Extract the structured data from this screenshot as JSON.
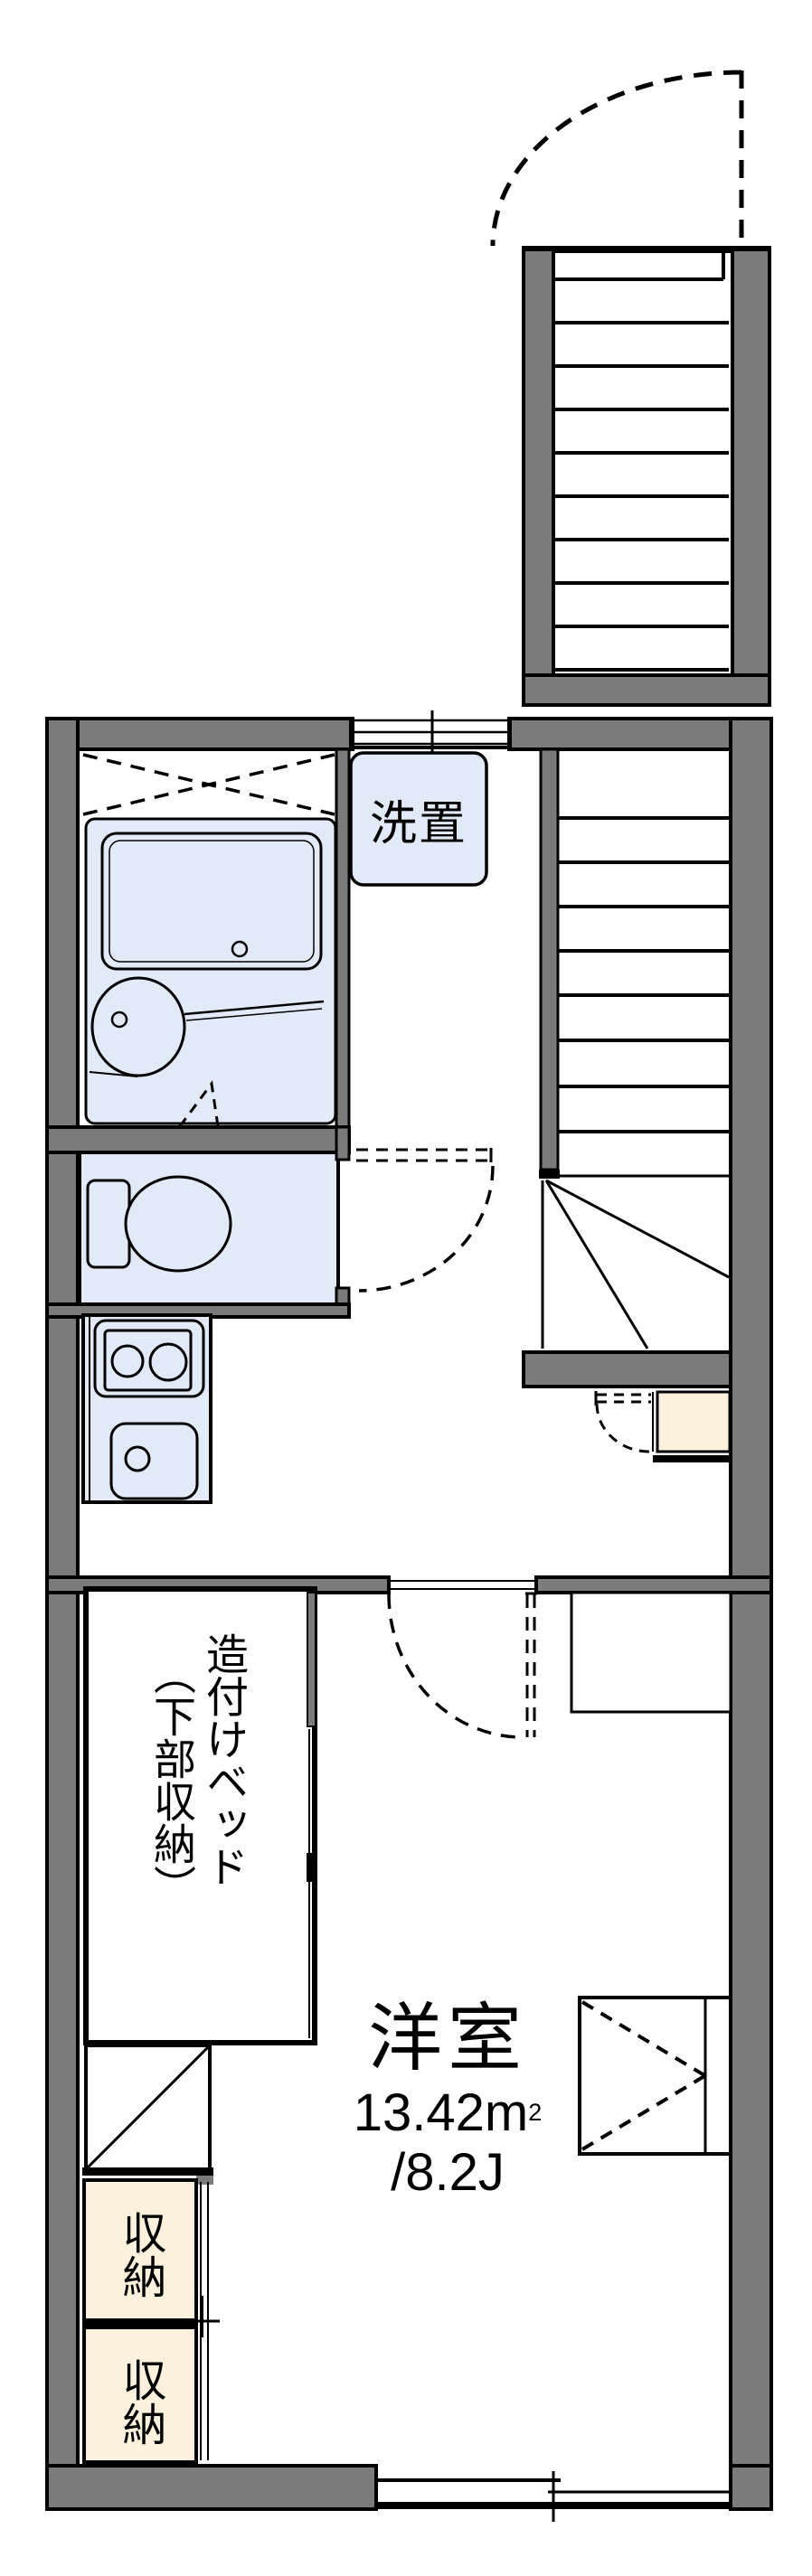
{
  "floorplan": {
    "laundry_label": "洗置",
    "bed_label_column1": "造付けベッド",
    "bed_label_column2": "（下部収納）",
    "room_name": "洋室",
    "room_area_sqm": "13.42m",
    "room_area_sqm_exponent": "2",
    "room_area_tatami": "/8.2J",
    "storage_upper_label": "収納",
    "storage_lower_label": "収納",
    "colors": {
      "wall_gray": "#7b7b7b",
      "fixture_blue": "#e2eaf8",
      "storage_cream": "#fbf1dc",
      "line_black": "#000000"
    }
  }
}
